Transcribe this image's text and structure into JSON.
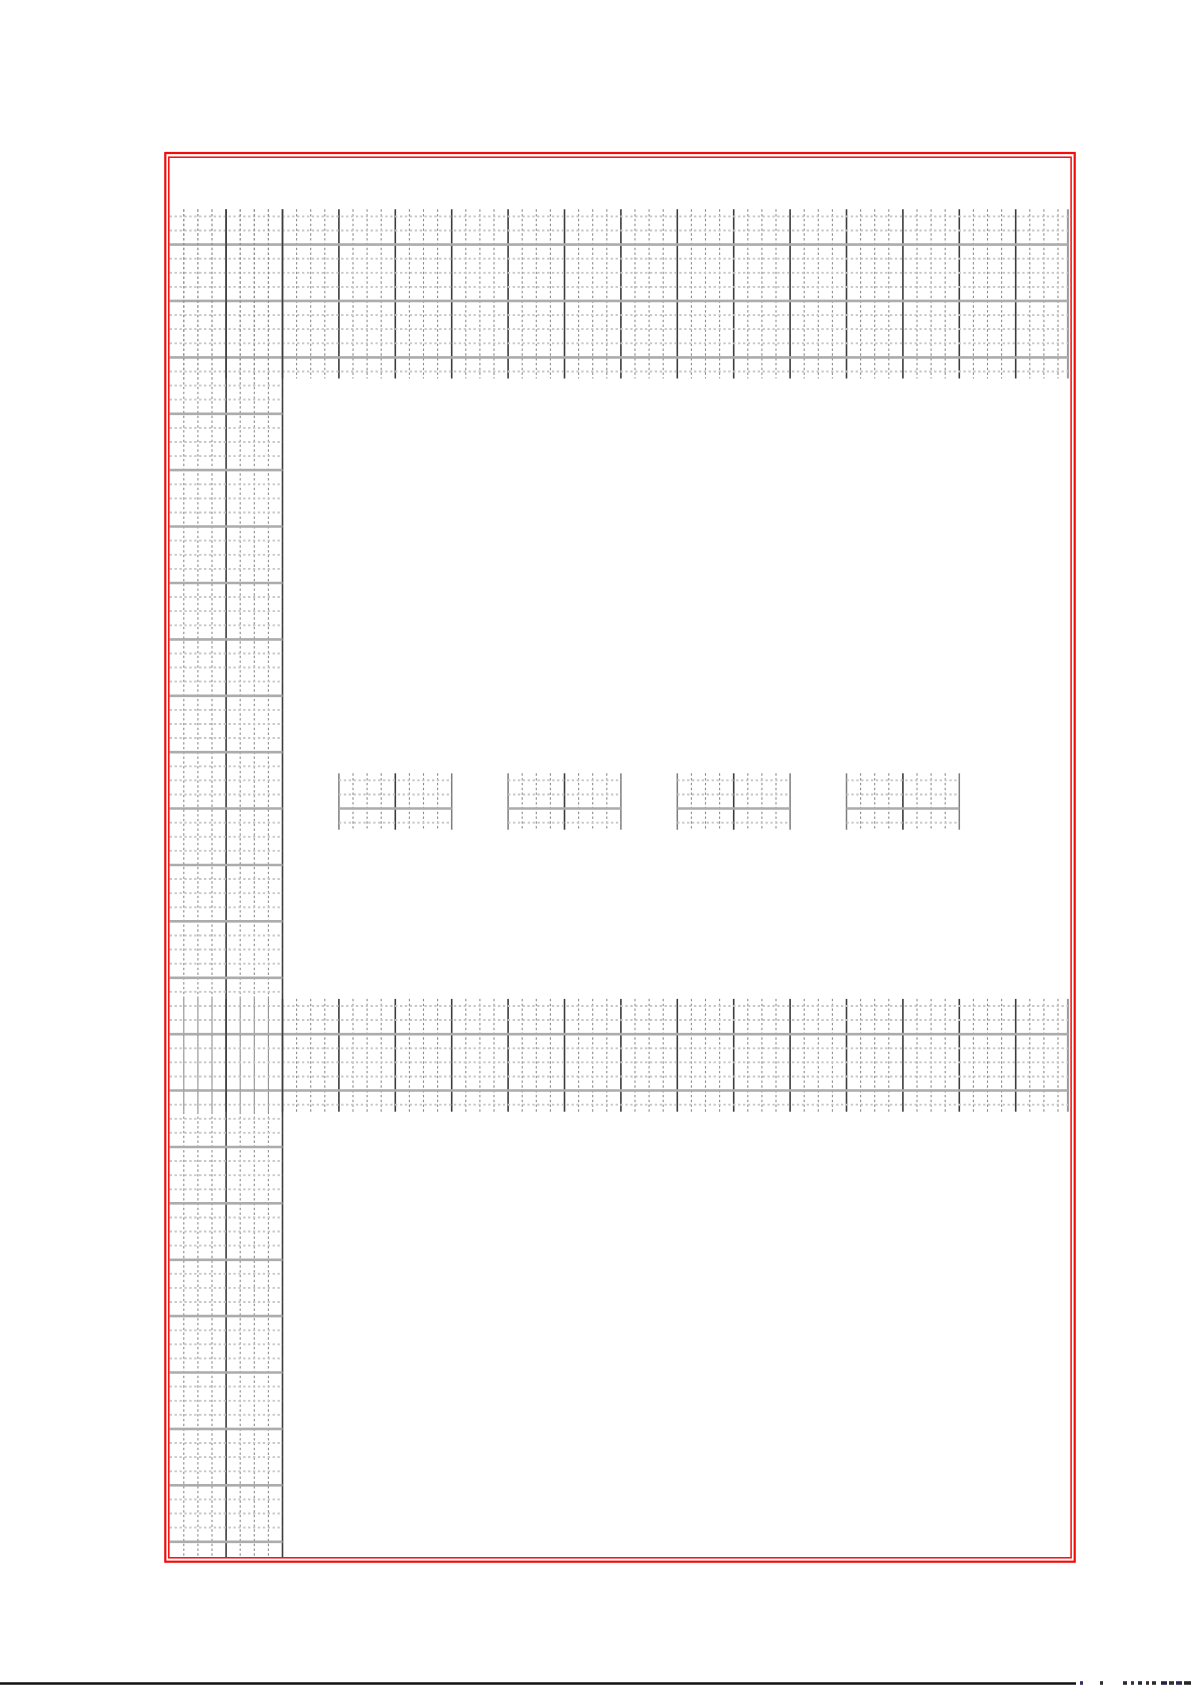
{
  "page": {
    "kind": "grid-paper-sheet-scan",
    "width": 1192,
    "height": 1685,
    "background": "#ffffff"
  },
  "border": {
    "color": "#f20d0d",
    "outer": {
      "x": 165.3,
      "y": 153.0,
      "w": 909.4,
      "h": 1408.7,
      "stroke_w": 2.2
    },
    "inner": {
      "x": 168.8,
      "y": 157.2,
      "w": 902.3,
      "h": 1400.6,
      "stroke_w": 1.5
    }
  },
  "grid_spec": {
    "origin_x": 169.7,
    "origin_y": 209.3,
    "cell": 14.1,
    "major_every": 4,
    "colors": {
      "minor_v": "#8c8c8c",
      "major_v": "#3c3c3c",
      "edge_v": "#9a9a9a",
      "block_edge_v": "#7d7d7d",
      "minor_h": "#c7c7c7",
      "major_h": "#acacac"
    },
    "strokes": {
      "minor_v_w": 1.1,
      "minor_v_dash": "2.4 2.4",
      "major_v_w": 1.6,
      "edge_v_w": 2.0,
      "block_edge_v_w": 1.5,
      "minor_h_w": 1.9,
      "minor_h_dash": "2.3 2.6",
      "major_h_w": 2.6
    },
    "bands": [
      {
        "name": "top-grid-band",
        "col_start": 0,
        "col_end": 63.7,
        "row_start": 0,
        "row_end": 12
      },
      {
        "name": "middle-grid-band",
        "col_start": 0,
        "col_end": 63.7,
        "row_start": 56,
        "row_end": 64
      }
    ],
    "column": {
      "name": "left-grid-column",
      "col_start": 0,
      "col_end": 8,
      "row_start": 0,
      "row_end": 95.65,
      "h_row_max": 94,
      "skip_h_rows": [
        [
          0,
          11
        ],
        [
          56,
          63
        ]
      ]
    },
    "blocks": {
      "name": "practice-block",
      "row_start": 40,
      "row_end": 44,
      "col_ranges": [
        [
          12,
          20
        ],
        [
          24,
          32
        ],
        [
          36,
          44
        ],
        [
          48,
          56
        ]
      ]
    }
  },
  "footer": {
    "rule": {
      "x1": 0,
      "x2": 1076,
      "y": 1683.5,
      "color": "#111111",
      "stroke_w": 2.6
    },
    "clipped_text_note": "illegible clipped text at sheet bottom edge",
    "fragments": [
      {
        "x": 1080,
        "w": 3,
        "color": "#30306a"
      },
      {
        "x": 1100,
        "w": 3,
        "color": "#2e2e2e"
      },
      {
        "x": 1123,
        "w": 4,
        "color": "#2a2a3a"
      },
      {
        "x": 1131,
        "w": 3,
        "color": "#333333"
      },
      {
        "x": 1138,
        "w": 4,
        "color": "#262646"
      },
      {
        "x": 1146,
        "w": 3,
        "color": "#3a2a2a"
      },
      {
        "x": 1152,
        "w": 4,
        "color": "#2c2c2c"
      },
      {
        "x": 1161,
        "w": 6,
        "color": "#22224a"
      },
      {
        "x": 1169,
        "w": 5,
        "color": "#303030"
      },
      {
        "x": 1176,
        "w": 6,
        "color": "#2a2a50"
      },
      {
        "x": 1184,
        "w": 7,
        "color": "#262626"
      }
    ],
    "fragment_y": 1681.2,
    "fragment_h": 3.6
  }
}
